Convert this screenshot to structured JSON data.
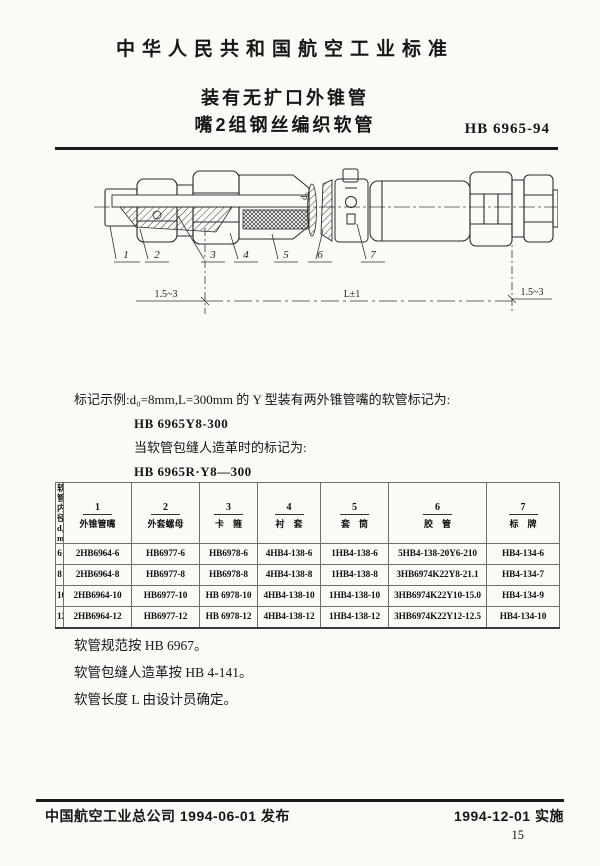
{
  "page": {
    "page_number": "15",
    "paper_color": "#fbfaf6",
    "ink_color": "#161616"
  },
  "header": {
    "standard_title": "中华人民共和国航空工业标准",
    "subtitle_line1": "装有无扩口外锥管",
    "subtitle_line2": "嘴2组钢丝编织软管",
    "standard_code": "HB 6965-94"
  },
  "drawing": {
    "part_labels": [
      "1",
      "2",
      "3",
      "4",
      "5",
      "6",
      "7"
    ],
    "dim_left": "1.5~3",
    "dim_right": "1.5~3",
    "dim_length": "L±1",
    "diameter_label": "d₀"
  },
  "marking": {
    "line1": "标记示例:d₀=8mm,L=300mm 的 Y 型装有两外锥管嘴的软管标记为:",
    "code1": "HB 6965Y8-300",
    "line2": "当软管包缝人造革时的标记为:",
    "code2": "HB 6965R·Y8—300"
  },
  "table": {
    "diameter_header": {
      "line1": "软管",
      "line2": "内径",
      "line3": "d₀",
      "line4": "mm"
    },
    "columns": [
      {
        "num": "1",
        "name": "外锥管嘴"
      },
      {
        "num": "2",
        "name": "外套螺母"
      },
      {
        "num": "3",
        "name": "卡箍"
      },
      {
        "num": "4",
        "name": "衬套"
      },
      {
        "num": "5",
        "name": "套筒"
      },
      {
        "num": "6",
        "name": "胶管"
      },
      {
        "num": "7",
        "name": "标牌"
      }
    ],
    "rows": [
      {
        "d": "6",
        "cells": [
          "2HB6964-6",
          "HB6977-6",
          "HB6978-6",
          "4HB4-138-6",
          "1HB4-138-6",
          "5HB4-138-20Y6-210",
          "HB4-134-6"
        ]
      },
      {
        "d": "8",
        "cells": [
          "2HB6964-8",
          "HB6977-8",
          "HB6978-8",
          "4HB4-138-8",
          "1HB4-138-8",
          "3HB6974K22Y8-21.1",
          "HB4-134-7"
        ]
      },
      {
        "d": "10",
        "cells": [
          "2HB6964-10",
          "HB6977-10",
          "HB 6978-10",
          "4HB4-138-10",
          "1HB4-138-10",
          "3HB6974K22Y10-15.0",
          "HB4-134-9"
        ]
      },
      {
        "d": "12",
        "cells": [
          "2HB6964-12",
          "HB6977-12",
          "HB 6978-12",
          "4HB4-138-12",
          "1HB4-138-12",
          "3HB6974K22Y12-12.5",
          "HB4-134-10"
        ]
      }
    ]
  },
  "notes": [
    "软管规范按 HB 6967。",
    "软管包缝人造革按 HB 4-141。",
    "软管长度 L 由设计员确定。"
  ],
  "footer": {
    "issue": "中国航空工业总公司 1994-06-01 发布",
    "implement": "1994-12-01 实施"
  }
}
